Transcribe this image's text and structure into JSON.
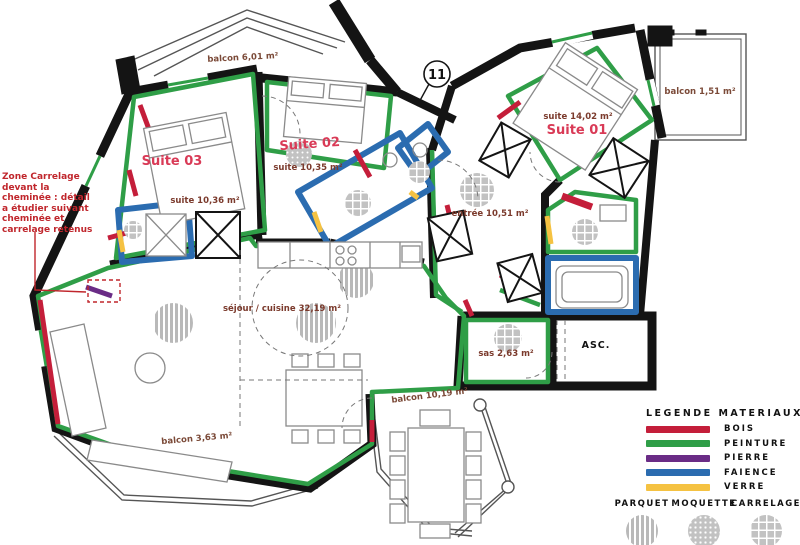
{
  "plan": {
    "unit_number": "11",
    "annotation": "Zone Carrelage devant la cheminée : détail a étudier suivant cheminée et carrelage retenus",
    "labels": {
      "suite03_title": "Suite 03",
      "suite03_area": "suite 10,36 m²",
      "suite02_title": "Suite 02",
      "suite02_area": "suite 10,35 m²",
      "suite01_title": "Suite 01",
      "suite01_area": "suite 14,02 m²",
      "entree_area": "entrée 10,51 m²",
      "sejour_area": "séjour / cuisine 32,19 m²",
      "sas_area": "sas 2,63 m²",
      "asc": "ASC.",
      "balcon_nw": "balcon 6,01 m²",
      "balcon_ne": "balcon 1,51 m²",
      "balcon_s": "balcon 10,19 m²",
      "balcon_sw": "balcon 3,63 m²"
    }
  },
  "legend": {
    "title": "LEGENDE MATERIAUX",
    "materials": [
      {
        "label": "BOIS",
        "color": "#c41e3a"
      },
      {
        "label": "PEINTURE",
        "color": "#2f9e47"
      },
      {
        "label": "PIERRE",
        "color": "#6a2c86"
      },
      {
        "label": "FAIENCE",
        "color": "#2b6cb0"
      },
      {
        "label": "VERRE",
        "color": "#f5c242"
      }
    ],
    "floors": [
      {
        "label": "PARQUET",
        "pattern": "stripes"
      },
      {
        "label": "MOQUETTE",
        "pattern": "dots"
      },
      {
        "label": "CARRELAGE",
        "pattern": "grid"
      }
    ]
  }
}
